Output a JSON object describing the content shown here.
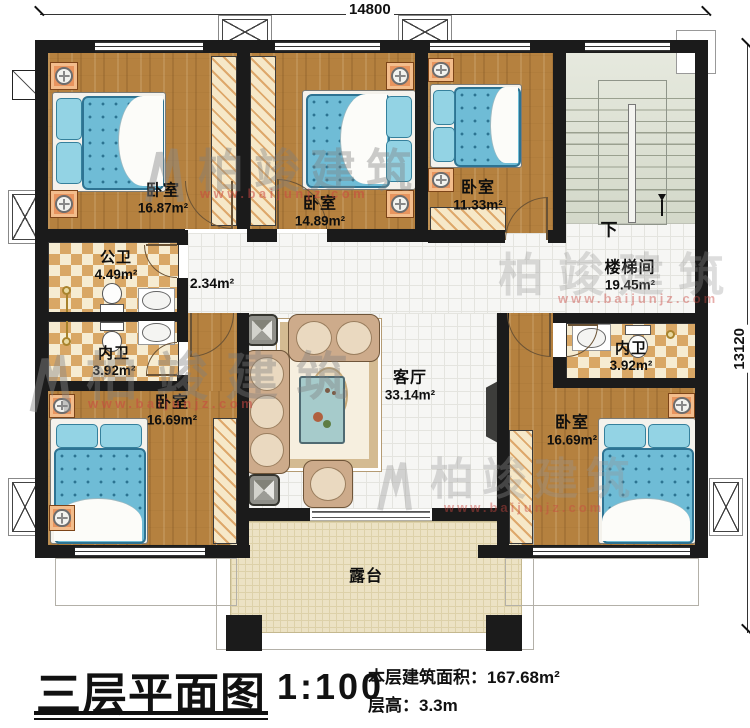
{
  "dimensions": {
    "top": "14800",
    "right": "13120"
  },
  "rooms": {
    "bedroom_tl": {
      "name": "卧室",
      "area": "16.87m²"
    },
    "bedroom_tm": {
      "name": "卧室",
      "area": "14.89m²"
    },
    "bedroom_tr": {
      "name": "卧室",
      "area": "11.33m²"
    },
    "stairwell": {
      "name": "楼梯间",
      "area": "19.45m²"
    },
    "public_bath": {
      "name": "公卫",
      "area": "4.49m²"
    },
    "hallway": {
      "area": "2.34m²"
    },
    "ensuite_left": {
      "name": "内卫",
      "area": "3.92m²"
    },
    "ensuite_right": {
      "name": "内卫",
      "area": "3.92m²"
    },
    "living": {
      "name": "客厅",
      "area": "33.14m²"
    },
    "bedroom_bl": {
      "name": "卧室",
      "area": "16.69m²"
    },
    "bedroom_br": {
      "name": "卧室",
      "area": "16.69m²"
    },
    "terrace": {
      "name": "露台"
    }
  },
  "stairs": {
    "down_label": "下"
  },
  "watermark": {
    "brand": "柏竣建筑",
    "url": "www.baijunjz.com"
  },
  "titleblock": {
    "title": "三层平面图",
    "scale": "1:100",
    "area_label": "本层建筑面积：",
    "area_value": "167.68m²",
    "floor_height_label": "层高：",
    "floor_height_value": "3.3m"
  }
}
